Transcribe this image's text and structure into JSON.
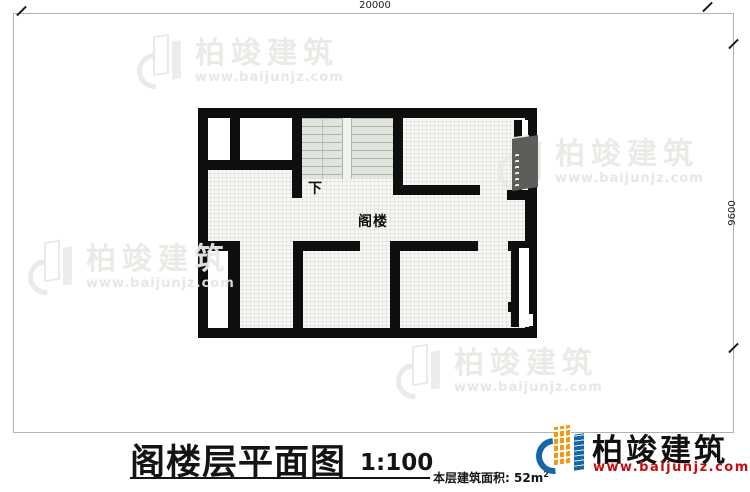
{
  "sheet": {
    "dimension_top": "20000",
    "dimension_right": "9600"
  },
  "plan": {
    "stair_down_label": "下",
    "room_label": "阁楼"
  },
  "title_block": {
    "title": "阁楼层平面图",
    "scale": "1:100",
    "area_label": "本层建筑面积:",
    "area_value": "52m",
    "area_exponent": "2"
  },
  "brand": {
    "name": "柏竣建筑",
    "website": "www.baijunjz.com",
    "colors": {
      "blue": "#1565a8",
      "orange": "#f5980c",
      "url_red": "#c40f0f"
    }
  },
  "watermark": {
    "name": "柏竣建筑",
    "website": "www.baijunjz.com"
  },
  "colors": {
    "wall": "#0e0e0e",
    "floor_hatch": "#f7f7f4",
    "stair_fill": "#e0e5dd",
    "stair_line": "#aeb6ac",
    "frame_gray": "#b2b2b0"
  }
}
